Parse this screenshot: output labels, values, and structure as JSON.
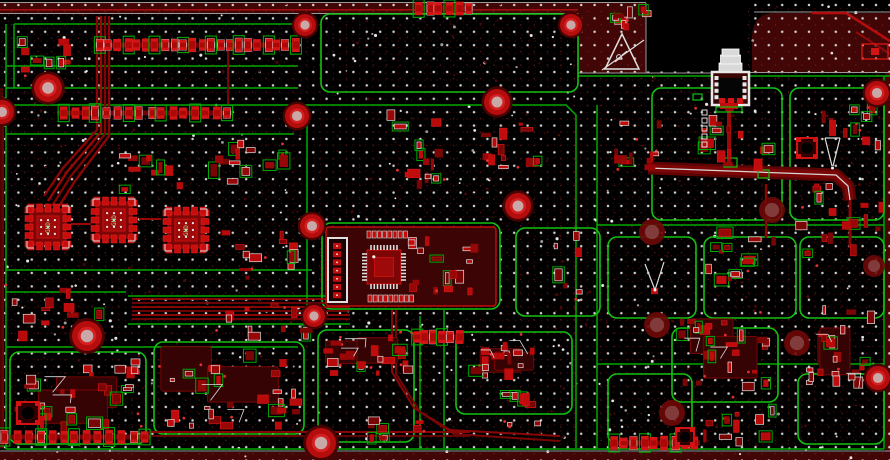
{
  "canvas": {
    "width": 890,
    "height": 460
  },
  "colors": {
    "bg": "#000000",
    "plane": "#420606",
    "plane_edge": "#4a0404",
    "bright_red": "#cf0f0f",
    "pad_red": "#d41414",
    "mid_red": "#a30808",
    "dark_red": "#6b0505",
    "plate": "#3c0404",
    "green": "#00a800",
    "green_bright": "#12c212",
    "white": "#e8e8e8",
    "gray": "#9a9a9a",
    "dim_dot": "#3a0606",
    "via_dot": "#e3e3e3",
    "hole_ring": "#b50d0d",
    "hole_core": "#c9a8a8",
    "soft_hole": "#6e0808",
    "label_green": "#9fe09f"
  },
  "grids": {
    "fine": {
      "spacing": 6.5,
      "r": 0.75
    },
    "vias": {
      "spacing": 13.4,
      "r": 1.25
    },
    "extra_white_dots": 170,
    "extra_dim_dots": 260
  },
  "board": {
    "top_rail": {
      "path": "M0,3 H646 V73 H578 V14 H0 Z",
      "bright_line": [
        0,
        9,
        578,
        1.5
      ]
    },
    "right_plane": {
      "path": "M752,73 V38 Q752,13 776,13 H890 V73 Z"
    },
    "edge_bands": [
      [
        885,
        73,
        5,
        379
      ],
      [
        0,
        88,
        3,
        360
      ]
    ],
    "bottom_rail": [
      0,
      452,
      890,
      8
    ],
    "notch": [
      646.5,
      0,
      101,
      71.5
    ],
    "edge_lines": [
      [
        [
          0,
          2.5
        ],
        [
          646,
          2.5
        ]
      ],
      [
        [
          0,
          13.5
        ],
        [
          578,
          13.5
        ]
      ],
      [
        [
          578,
          13.5
        ],
        [
          578,
          73
        ]
      ],
      [
        [
          646,
          3
        ],
        [
          646,
          73
        ]
      ],
      [
        [
          578,
          73
        ],
        [
          712,
          73
        ]
      ],
      [
        [
          748,
          72.5
        ],
        [
          890,
          72.5
        ]
      ],
      [
        [
          754,
          12
        ],
        [
          890,
          12
        ]
      ],
      [
        [
          0,
          451
        ],
        [
          890,
          451
        ]
      ]
    ]
  },
  "green_lines": [
    [
      [
        14,
        24
      ],
      [
        298,
        24
      ]
    ],
    [
      [
        14,
        24
      ],
      [
        14,
        88
      ]
    ],
    [
      [
        6,
        66
      ],
      [
        298,
        66
      ]
    ],
    [
      [
        6,
        88
      ],
      [
        298,
        88
      ]
    ],
    [
      [
        6,
        105
      ],
      [
        566,
        105
      ],
      [
        576,
        115
      ],
      [
        576,
        448
      ]
    ],
    [
      [
        597,
        105
      ],
      [
        597,
        448
      ]
    ],
    [
      [
        578,
        76
      ],
      [
        890,
        76
      ]
    ],
    [
      [
        6,
        134
      ],
      [
        294,
        134
      ]
    ],
    [
      [
        6,
        24
      ],
      [
        6,
        449
      ]
    ],
    [
      [
        884,
        76
      ],
      [
        884,
        449
      ]
    ],
    [
      [
        597,
        225
      ],
      [
        884,
        225
      ]
    ],
    [
      [
        6,
        270
      ],
      [
        312,
        270
      ]
    ],
    [
      [
        6,
        292
      ],
      [
        126,
        292
      ]
    ],
    [
      [
        128,
        296
      ],
      [
        350,
        296
      ]
    ],
    [
      [
        128,
        324
      ],
      [
        350,
        324
      ]
    ],
    [
      [
        6,
        347
      ],
      [
        298,
        347
      ]
    ],
    [
      [
        307,
        108
      ],
      [
        307,
        330
      ]
    ],
    [
      [
        420,
        316
      ],
      [
        420,
        448
      ]
    ],
    [
      [
        444,
        310
      ],
      [
        444,
        448
      ]
    ],
    [
      [
        597,
        364
      ],
      [
        884,
        364
      ]
    ],
    [
      [
        6,
        449
      ],
      [
        884,
        449
      ]
    ]
  ],
  "zones": [
    [
      321,
      14,
      257,
      78
    ],
    [
      322,
      223,
      178,
      86
    ],
    [
      516,
      228,
      84,
      88
    ],
    [
      608,
      237,
      88,
      81
    ],
    [
      704,
      237,
      92,
      81
    ],
    [
      800,
      237,
      84,
      81
    ],
    [
      652,
      88,
      130,
      132
    ],
    [
      790,
      88,
      94,
      132
    ],
    [
      10,
      352,
      136,
      92
    ],
    [
      154,
      342,
      150,
      92
    ],
    [
      318,
      330,
      96,
      112
    ],
    [
      456,
      332,
      116,
      82
    ],
    [
      608,
      374,
      84,
      70
    ],
    [
      672,
      328,
      106,
      74
    ],
    [
      798,
      374,
      86,
      70
    ]
  ],
  "traces": [
    {
      "p": [
        [
          97,
          16
        ],
        [
          97,
          130
        ],
        [
          63,
          168
        ],
        [
          44,
          196
        ]
      ],
      "w": 2.4,
      "c": "#8a0606"
    },
    {
      "p": [
        [
          101,
          16
        ],
        [
          101,
          132
        ],
        [
          67,
          172
        ],
        [
          48,
          201
        ]
      ],
      "w": 2.4,
      "c": "#9a0707"
    },
    {
      "p": [
        [
          105,
          16
        ],
        [
          105,
          134
        ],
        [
          71,
          176
        ],
        [
          52,
          206
        ]
      ],
      "w": 2.4,
      "c": "#7d0505"
    },
    {
      "p": [
        [
          109,
          16
        ],
        [
          109,
          136
        ],
        [
          75,
          181
        ],
        [
          56,
          211
        ]
      ],
      "w": 2.4,
      "c": "#8a0606"
    },
    {
      "p": [
        [
          132,
          299
        ],
        [
          350,
          299
        ]
      ],
      "w": 1.7,
      "c": "#9a0707"
    },
    {
      "p": [
        [
          132,
          303
        ],
        [
          350,
          303
        ]
      ],
      "w": 1.7,
      "c": "#7a0505"
    },
    {
      "p": [
        [
          132,
          307
        ],
        [
          350,
          307
        ]
      ],
      "w": 1.7,
      "c": "#9a0707"
    },
    {
      "p": [
        [
          132,
          311
        ],
        [
          350,
          311
        ]
      ],
      "w": 1.7,
      "c": "#7a0505"
    },
    {
      "p": [
        [
          132,
          315
        ],
        [
          350,
          315
        ]
      ],
      "w": 1.7,
      "c": "#9a0707"
    },
    {
      "p": [
        [
          132,
          319
        ],
        [
          350,
          319
        ]
      ],
      "w": 1.7,
      "c": "#7a0505"
    },
    {
      "p": [
        [
          729,
          102
        ],
        [
          729,
          170
        ]
      ],
      "w": 4,
      "c": "#9a0808"
    },
    {
      "p": [
        [
          812,
          13
        ],
        [
          846,
          13
        ],
        [
          890,
          41
        ]
      ],
      "w": 2.6,
      "c": "#b50d0d"
    },
    {
      "p": [
        [
          856,
          32
        ],
        [
          890,
          54
        ]
      ],
      "w": 1.8,
      "c": "#9a0808"
    },
    {
      "p": [
        [
          392,
          310
        ],
        [
          392,
          372
        ],
        [
          414,
          408
        ],
        [
          450,
          430
        ],
        [
          560,
          436
        ]
      ],
      "w": 2,
      "c": "#8a0606"
    },
    {
      "p": [
        [
          396,
          310
        ],
        [
          396,
          374
        ],
        [
          420,
          412
        ],
        [
          454,
          434
        ],
        [
          560,
          441
        ]
      ],
      "w": 2,
      "c": "#7a0505"
    },
    {
      "p": [
        [
          150,
          432
        ],
        [
          470,
          432
        ]
      ],
      "w": 2,
      "c": "#8a0606"
    },
    {
      "p": [
        [
          150,
          436
        ],
        [
          470,
          436
        ]
      ],
      "w": 1.7,
      "c": "#6e0404"
    },
    {
      "p": [
        [
          850,
          196
        ],
        [
          850,
          248
        ]
      ],
      "w": 3,
      "c": "#8a0606"
    },
    {
      "p": [
        [
          3,
          96
        ],
        [
          3,
          448
        ]
      ],
      "w": 1.8,
      "c": "#6b0505"
    },
    {
      "p": [
        [
          71,
          224
        ],
        [
          91,
          224
        ]
      ],
      "w": 2,
      "c": "#9a0707"
    },
    {
      "p": [
        [
          139,
          219
        ],
        [
          161,
          219
        ]
      ],
      "w": 2,
      "c": "#9a0707"
    },
    {
      "p": [
        [
          766,
          184
        ],
        [
          766,
          238
        ]
      ],
      "w": 2.4,
      "c": "#8a0606"
    },
    {
      "p": [
        [
          228,
          48
        ],
        [
          228,
          104
        ]
      ],
      "w": 2,
      "c": "#7a0505"
    }
  ],
  "bus": {
    "p": [
      [
        648,
        168
      ],
      [
        836,
        175
      ],
      [
        848,
        186
      ],
      [
        850,
        200
      ]
    ],
    "outer": 13,
    "inner": 8
  },
  "plane_box": {
    "rect": [
      862,
      44,
      26,
      15
    ],
    "pad": [
      871,
      48,
      8,
      7
    ]
  },
  "holes": {
    "bright": [
      [
        48,
        88,
        14
      ],
      [
        297,
        116,
        12
      ],
      [
        305,
        25,
        11
      ],
      [
        571,
        25,
        11
      ],
      [
        497,
        102,
        13
      ],
      [
        312,
        226,
        12
      ],
      [
        518,
        206,
        13
      ],
      [
        314,
        316,
        11
      ],
      [
        87,
        336,
        15
      ],
      [
        321,
        443,
        15
      ],
      [
        877,
        93,
        12
      ],
      [
        878,
        378,
        12
      ],
      [
        2,
        112,
        12
      ]
    ],
    "soft": [
      [
        652,
        232,
        13
      ],
      [
        772,
        210,
        13
      ],
      [
        657,
        325,
        13
      ],
      [
        797,
        343,
        13
      ],
      [
        672,
        413,
        13
      ],
      [
        874,
        266,
        11
      ]
    ]
  },
  "ics": [
    {
      "x": 48,
      "y": 227,
      "s": 46,
      "label": "GND"
    },
    {
      "x": 114,
      "y": 220,
      "s": 46,
      "label": "GND"
    },
    {
      "x": 186,
      "y": 230,
      "s": 46,
      "label": "GND"
    }
  ],
  "module": {
    "zone_plate": [
      326,
      227,
      170,
      79
    ],
    "qfp": {
      "x": 384,
      "y": 267,
      "s": 34,
      "pins": 9
    },
    "pad_rows": [
      {
        "x": 367,
        "y": 231,
        "n": 8,
        "step": 5.2,
        "w": 4,
        "h": 7
      },
      {
        "x": 368,
        "y": 295,
        "n": 9,
        "step": 5.2,
        "w": 4,
        "h": 7
      }
    ],
    "header": {
      "x": 328,
      "y": 238,
      "w": 19,
      "h": 64,
      "pads": 7
    }
  },
  "top_connector": {
    "base": [
      712,
      72,
      37,
      33
    ],
    "stack": [
      [
        719,
        63,
        23,
        10
      ],
      [
        720.5,
        55,
        20,
        9
      ],
      [
        722,
        49,
        17,
        7
      ]
    ],
    "side_pads": 4,
    "bottom_pads": 3,
    "tail_pad": [
      720,
      103,
      18,
      6
    ],
    "tail_tick": [
      716,
      107,
      26,
      5
    ]
  },
  "esd_symbol": {
    "apex": [
      622,
      34
    ],
    "base_l": [
      605,
      69
    ],
    "base_r": [
      639,
      69
    ],
    "slash": [
      [
        602,
        70
      ],
      [
        644,
        40
      ]
    ],
    "hand": [
      619,
      57
    ]
  },
  "antennas": [
    {
      "stub": [
        829,
        120,
        7,
        16
      ],
      "lines": [
        [
          [
            825,
            138
          ],
          [
            832,
            166
          ]
        ],
        [
          [
            840,
            138
          ],
          [
            833,
            166
          ]
        ],
        [
          [
            825,
            138
          ],
          [
            840,
            138
          ]
        ]
      ],
      "dot": [
        832.5,
        168
      ]
    },
    {
      "stub": [
        651,
        288,
        7,
        6
      ],
      "lines": [
        [
          [
            645,
            264
          ],
          [
            655,
            290
          ]
        ],
        [
          [
            664,
            262
          ],
          [
            655,
            290
          ]
        ]
      ],
      "dot": [
        655,
        290
      ]
    }
  ],
  "inductors": [
    [
      17,
      402,
      22
    ],
    [
      797,
      138,
      20
    ],
    [
      676,
      428,
      18
    ]
  ],
  "pad_columns": [
    {
      "x": 702,
      "y": 110,
      "n": 5,
      "step": 8,
      "s": 5
    }
  ],
  "green_ticks": [
    [
      758,
      170,
      11,
      8
    ],
    [
      724,
      158,
      13,
      9
    ],
    [
      693,
      94,
      9,
      6
    ]
  ],
  "clusters": [
    [
      95,
      30,
      205,
      30,
      22,
      "row"
    ],
    [
      58,
      100,
      175,
      26,
      16,
      "row"
    ],
    [
      16,
      34,
      64,
      42,
      9,
      "patch"
    ],
    [
      205,
      140,
      95,
      46,
      13,
      "patch"
    ],
    [
      222,
      228,
      82,
      56,
      12,
      "patch"
    ],
    [
      100,
      152,
      92,
      42,
      10,
      "patch"
    ],
    [
      383,
      106,
      64,
      84,
      14,
      "patch"
    ],
    [
      476,
      116,
      72,
      56,
      12,
      "patch"
    ],
    [
      545,
      228,
      58,
      76,
      8,
      "sparse"
    ],
    [
      608,
      116,
      58,
      56,
      10,
      "patch"
    ],
    [
      686,
      96,
      88,
      86,
      15,
      "patch"
    ],
    [
      700,
      228,
      80,
      86,
      13,
      "patch"
    ],
    [
      795,
      182,
      92,
      84,
      16,
      "patch"
    ],
    [
      818,
      98,
      64,
      58,
      9,
      "patch"
    ],
    [
      0,
      284,
      112,
      58,
      13,
      "patch"
    ],
    [
      14,
      356,
      130,
      86,
      20,
      "dense"
    ],
    [
      158,
      346,
      144,
      86,
      20,
      "dense"
    ],
    [
      208,
      298,
      118,
      44,
      11,
      "patch"
    ],
    [
      322,
      332,
      94,
      44,
      12,
      "dense"
    ],
    [
      470,
      334,
      74,
      48,
      11,
      "dense"
    ],
    [
      495,
      392,
      50,
      36,
      7,
      "patch"
    ],
    [
      678,
      318,
      98,
      76,
      17,
      "dense"
    ],
    [
      700,
      396,
      82,
      52,
      10,
      "patch"
    ],
    [
      806,
      300,
      80,
      94,
      15,
      "dense"
    ],
    [
      608,
      428,
      92,
      30,
      9,
      "row"
    ],
    [
      368,
      414,
      60,
      40,
      8,
      "patch"
    ],
    [
      415,
      2,
      58,
      13,
      6,
      "row"
    ],
    [
      604,
      6,
      52,
      24,
      8,
      "patch"
    ],
    [
      0,
      424,
      150,
      26,
      13,
      "row"
    ],
    [
      412,
      330,
      52,
      14,
      6,
      "row"
    ],
    [
      408,
      236,
      86,
      62,
      16,
      "patch"
    ]
  ]
}
